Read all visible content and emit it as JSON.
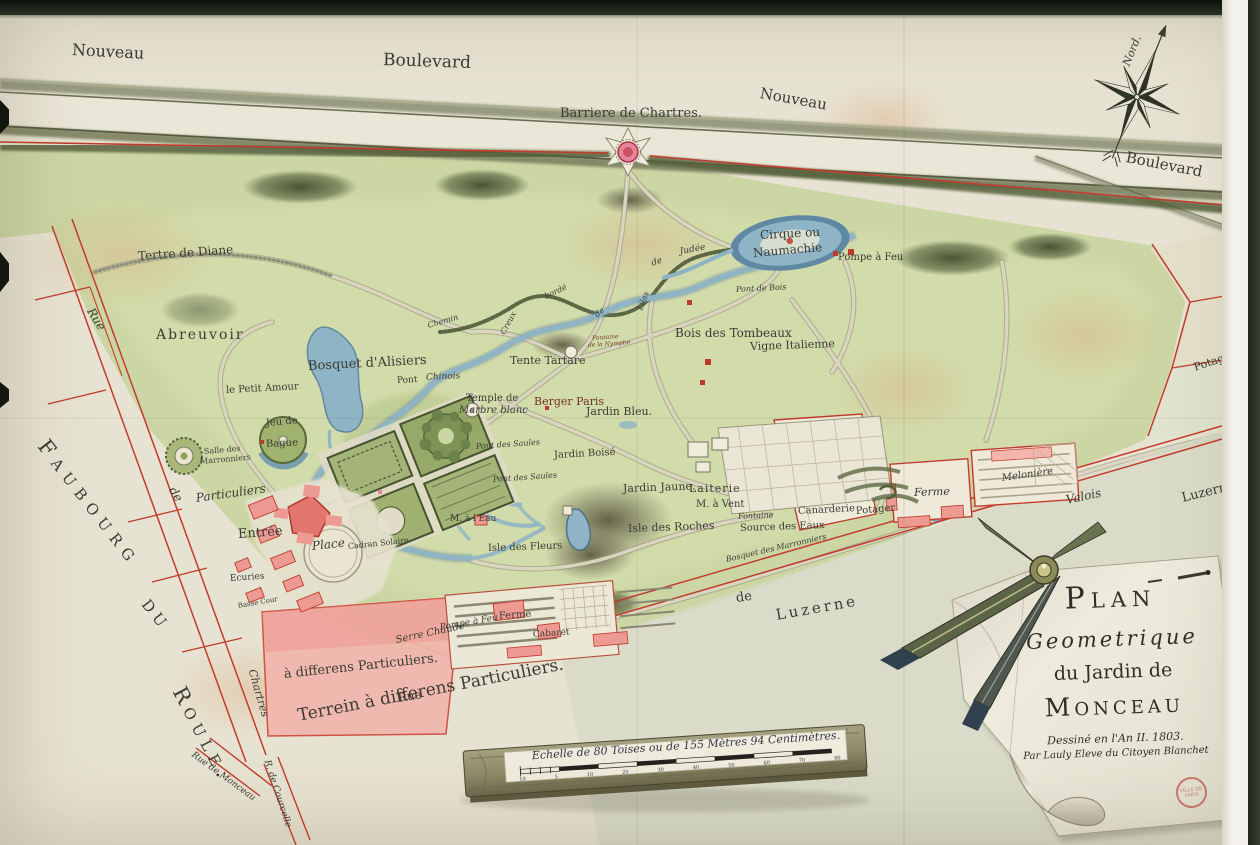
{
  "map": {
    "cartouche": {
      "line1": "Plan",
      "line2": "Geometrique",
      "line3": "du Jardin de",
      "line4": "Monceau",
      "line5": "Dessiné en l'An II. 1803.",
      "line6": "Par Lauly Eleve du Citoyen Blanchet",
      "stamp": "Ville de Paris"
    },
    "compass": {
      "north_label": "Nord."
    },
    "scale_bar": {
      "label": "Echelle de 80 Toises ou de 155 Mètres 94 Centimètres.",
      "ticks": [
        "10",
        "5",
        "10",
        "20",
        "30",
        "40",
        "50",
        "60",
        "70",
        "80"
      ]
    },
    "colors": {
      "paper": "#e7e3d2",
      "park_green": "#ccd6a4",
      "hedge": "#55603a",
      "water": "#8fb4c6",
      "boundary_red": "#c23b2c",
      "building_pink": "#ec9b94",
      "ink": "#3a3c34"
    },
    "labels": [
      {
        "id": "nouveau-left",
        "t": "Nouveau",
        "x": 72,
        "y": 42,
        "s": 16,
        "r": 3
      },
      {
        "id": "boulevard-top",
        "t": "Boulevard",
        "x": 383,
        "y": 52,
        "s": 17,
        "r": 2
      },
      {
        "id": "nouveau-right",
        "t": "Nouveau",
        "x": 760,
        "y": 86,
        "s": 15,
        "r": 10
      },
      {
        "id": "boulevard-right",
        "t": "Boulevard",
        "x": 1126,
        "y": 150,
        "s": 15,
        "r": 11
      },
      {
        "id": "barriere-de-chartres",
        "t": "Barriere de Chartres.",
        "x": 560,
        "y": 107,
        "s": 13,
        "r": 0
      },
      {
        "id": "tertre-de-diane",
        "t": "Tertre de Diane",
        "x": 138,
        "y": 250,
        "s": 12,
        "r": -4
      },
      {
        "id": "abreuvoir",
        "t": "Abreuvoir",
        "x": 156,
        "y": 328,
        "s": 14,
        "r": 0,
        "sp": 2
      },
      {
        "id": "le-petit-amour",
        "t": "le Petit Amour",
        "x": 226,
        "y": 386,
        "s": 10,
        "r": -3
      },
      {
        "id": "bosquet-d-alisiers",
        "t": "Bosquet d'Alisiers",
        "x": 308,
        "y": 360,
        "s": 13,
        "r": -3
      },
      {
        "id": "rue-left",
        "t": "Rue",
        "x": 90,
        "y": 303,
        "s": 12,
        "r": 58,
        "i": 1
      },
      {
        "id": "de-left",
        "t": "de",
        "x": 172,
        "y": 482,
        "s": 12,
        "r": 58,
        "i": 1
      },
      {
        "id": "chartres-left",
        "t": "Chartres",
        "x": 252,
        "y": 664,
        "s": 11,
        "r": 74,
        "i": 1
      },
      {
        "id": "rue-de-monceau",
        "t": "Rue de Monceau",
        "x": 192,
        "y": 750,
        "s": 9,
        "r": 36,
        "i": 1
      },
      {
        "id": "rue-de-courcelle",
        "t": "R. de Courcelle",
        "x": 266,
        "y": 756,
        "s": 9,
        "r": 72,
        "i": 1
      },
      {
        "id": "faubourg",
        "t": "Faubourg",
        "x": 42,
        "y": 432,
        "s": 21,
        "r": 52,
        "sp": 7,
        "sc": 1
      },
      {
        "id": "du",
        "t": "du",
        "x": 146,
        "y": 590,
        "s": 21,
        "r": 52,
        "sp": 5,
        "sc": 1
      },
      {
        "id": "roule",
        "t": "Roule.",
        "x": 178,
        "y": 678,
        "s": 21,
        "r": 62,
        "sp": 6,
        "sc": 1
      },
      {
        "id": "terrein-particuliers",
        "t": "Terrein    à    differens    Particuliers.",
        "x": 298,
        "y": 708,
        "s": 17,
        "r": -11
      },
      {
        "id": "differens-particuliers-pink",
        "t": "à   differens   Particuliers.",
        "x": 284,
        "y": 668,
        "s": 13,
        "r": -6
      },
      {
        "id": "rue-bottom",
        "t": "Rue",
        "x": 398,
        "y": 692,
        "s": 12,
        "r": -9
      },
      {
        "id": "particuliers-entree",
        "t": "Particuliers",
        "x": 196,
        "y": 492,
        "s": 12,
        "r": -8,
        "i": 1
      },
      {
        "id": "entree",
        "t": "Entrée",
        "x": 238,
        "y": 528,
        "s": 13,
        "r": -4
      },
      {
        "id": "place",
        "t": "Place",
        "x": 312,
        "y": 540,
        "s": 12,
        "r": -6,
        "i": 1
      },
      {
        "id": "cadran-solaire",
        "t": "Cadran Solaire",
        "x": 348,
        "y": 543,
        "s": 8,
        "r": -6
      },
      {
        "id": "ecuries",
        "t": "Ecuries",
        "x": 230,
        "y": 575,
        "s": 9,
        "r": -4
      },
      {
        "id": "basse-cour",
        "t": "Basse Cour",
        "x": 238,
        "y": 603,
        "s": 7,
        "r": -10
      },
      {
        "id": "jeu-de",
        "t": "Jeu de",
        "x": 266,
        "y": 419,
        "s": 10,
        "r": -5
      },
      {
        "id": "bague",
        "t": "Bague",
        "x": 266,
        "y": 440,
        "s": 10,
        "r": -3
      },
      {
        "id": "salle-des",
        "t": "Salle des",
        "x": 204,
        "y": 448,
        "s": 8,
        "r": -5
      },
      {
        "id": "marronniers",
        "t": "Marronniers",
        "x": 200,
        "y": 458,
        "s": 8,
        "r": -5
      },
      {
        "id": "serre-chaude",
        "t": "Serre Chaude",
        "x": 396,
        "y": 636,
        "s": 10,
        "r": -12,
        "i": 1
      },
      {
        "id": "pompe-a-feu-bas",
        "t": "Pompe à Feu",
        "x": 440,
        "y": 624,
        "s": 9,
        "r": -10,
        "i": 1
      },
      {
        "id": "ferme-bas",
        "t": "Ferme",
        "x": 499,
        "y": 612,
        "s": 10,
        "r": -4
      },
      {
        "id": "cabaret",
        "t": "Cabaret",
        "x": 533,
        "y": 631,
        "s": 9,
        "r": -4
      },
      {
        "id": "temple-de",
        "t": "Temple de",
        "x": 466,
        "y": 394,
        "s": 10,
        "r": 0
      },
      {
        "id": "marbre-blanc",
        "t": "Marbre blanc",
        "x": 459,
        "y": 406,
        "s": 10,
        "r": 0,
        "i": 1
      },
      {
        "id": "tente-tartare",
        "t": "Tente Tartare",
        "x": 510,
        "y": 355,
        "s": 11,
        "r": 0
      },
      {
        "id": "berger-paris",
        "t": "Berger Paris",
        "x": 534,
        "y": 396,
        "s": 11,
        "r": 0,
        "c": "#71352a"
      },
      {
        "id": "jardin-bleu",
        "t": "Jardin Bleu.",
        "x": 586,
        "y": 406,
        "s": 11,
        "r": 0
      },
      {
        "id": "jardin-boise",
        "t": "Jardin Boisé",
        "x": 554,
        "y": 451,
        "s": 10,
        "r": -3
      },
      {
        "id": "pont-des-saules-1",
        "t": "Pont des Saules",
        "x": 476,
        "y": 443,
        "s": 8,
        "r": -4,
        "i": 1
      },
      {
        "id": "pont-des-saules-2",
        "t": "Pont des Saules",
        "x": 493,
        "y": 476,
        "s": 8,
        "r": -4,
        "i": 1
      },
      {
        "id": "pont",
        "t": "Pont",
        "x": 397,
        "y": 377,
        "s": 9,
        "r": -3
      },
      {
        "id": "pont-chinois",
        "t": "Chinois",
        "x": 426,
        "y": 374,
        "s": 9,
        "r": -3,
        "i": 1
      },
      {
        "id": "chemin",
        "t": "Chemin",
        "x": 428,
        "y": 322,
        "s": 8,
        "r": -16,
        "i": 1
      },
      {
        "id": "creux",
        "t": "Creux",
        "x": 503,
        "y": 330,
        "s": 8,
        "r": -62,
        "i": 1
      },
      {
        "id": "borde",
        "t": "bordé",
        "x": 545,
        "y": 293,
        "s": 8,
        "r": -25,
        "i": 1
      },
      {
        "id": "de-lilas",
        "t": "de",
        "x": 596,
        "y": 312,
        "s": 8,
        "r": -40,
        "i": 1
      },
      {
        "id": "lilas",
        "t": "Lilas",
        "x": 640,
        "y": 306,
        "s": 8,
        "r": -68,
        "i": 1
      },
      {
        "id": "de-judee",
        "t": "de",
        "x": 652,
        "y": 260,
        "s": 9,
        "r": -20,
        "i": 1
      },
      {
        "id": "judee",
        "t": "Judée",
        "x": 680,
        "y": 248,
        "s": 9,
        "r": -10,
        "i": 1
      },
      {
        "id": "fontaine-nymphe-1",
        "t": "Fontaine",
        "x": 592,
        "y": 336,
        "s": 6,
        "r": -4,
        "i": 1,
        "c": "#71352a"
      },
      {
        "id": "fontaine-nymphe-2",
        "t": "de la Nymphe",
        "x": 588,
        "y": 343,
        "s": 6,
        "r": -4,
        "i": 1,
        "c": "#71352a"
      },
      {
        "id": "cirque-ou",
        "t": "Cirque ou",
        "x": 760,
        "y": 229,
        "s": 12,
        "r": -3
      },
      {
        "id": "naumachie",
        "t": "Naumachie",
        "x": 753,
        "y": 247,
        "s": 12,
        "r": -5
      },
      {
        "id": "pompe-a-feu-droite",
        "t": "Pompe à Feu",
        "x": 838,
        "y": 253,
        "s": 10,
        "r": 0
      },
      {
        "id": "pont-de-bois",
        "t": "Pont de Bois",
        "x": 736,
        "y": 286,
        "s": 8,
        "r": -3,
        "i": 1
      },
      {
        "id": "bois-des-tombeaux",
        "t": "Bois des Tombeaux",
        "x": 675,
        "y": 327,
        "s": 12,
        "r": 0
      },
      {
        "id": "vigne-italienne",
        "t": "Vigne Italienne",
        "x": 750,
        "y": 341,
        "s": 11,
        "r": -2
      },
      {
        "id": "jardin-jaune",
        "t": "Jardin Jaune.",
        "x": 623,
        "y": 483,
        "s": 11,
        "r": -2
      },
      {
        "id": "laiterie",
        "t": "Laiterie",
        "x": 689,
        "y": 483,
        "s": 11,
        "r": 0,
        "sp": 1
      },
      {
        "id": "m-a-vent",
        "t": "M. à Vent",
        "x": 696,
        "y": 500,
        "s": 10,
        "r": 0
      },
      {
        "id": "fontaine-source",
        "t": "Fontaine",
        "x": 738,
        "y": 513,
        "s": 8,
        "r": -3,
        "i": 1
      },
      {
        "id": "source-des-eaux",
        "t": "Source des Eaux",
        "x": 740,
        "y": 524,
        "s": 10,
        "r": -2
      },
      {
        "id": "isle-des-roches",
        "t": "Isle des Roches",
        "x": 628,
        "y": 523,
        "s": 11,
        "r": -2
      },
      {
        "id": "canarderie",
        "t": "Canarderie",
        "x": 798,
        "y": 507,
        "s": 10,
        "r": -3
      },
      {
        "id": "potager-mid",
        "t": "Potager",
        "x": 856,
        "y": 507,
        "s": 10,
        "r": -5
      },
      {
        "id": "bosquet-des-marronniers",
        "t": "Bosquet des Marronniers",
        "x": 726,
        "y": 556,
        "s": 8,
        "r": -13,
        "i": 1
      },
      {
        "id": "m-a-l-eau",
        "t": "M. à l'Eau",
        "x": 450,
        "y": 515,
        "s": 9,
        "r": 0
      },
      {
        "id": "isle-des-fleurs",
        "t": "Isle des Fleurs",
        "x": 488,
        "y": 544,
        "s": 10,
        "r": -2
      },
      {
        "id": "ferme-droite",
        "t": "Ferme",
        "x": 914,
        "y": 487,
        "s": 11,
        "r": -2,
        "i": 1
      },
      {
        "id": "meloniere",
        "t": "Melonière",
        "x": 1002,
        "y": 474,
        "s": 10,
        "r": -8,
        "i": 1
      },
      {
        "id": "valois",
        "t": "Valois",
        "x": 1066,
        "y": 494,
        "s": 12,
        "r": -12,
        "i": 1
      },
      {
        "id": "luzerne-droite",
        "t": "Luzerne",
        "x": 1182,
        "y": 492,
        "s": 13,
        "r": -14
      },
      {
        "id": "potagers-droite",
        "t": "Potagers",
        "x": 1194,
        "y": 362,
        "s": 11,
        "r": -18
      },
      {
        "id": "de-luzerne",
        "t": "de",
        "x": 736,
        "y": 592,
        "s": 13,
        "r": -8
      },
      {
        "id": "luzerne-grand",
        "t": "Luzerne",
        "x": 776,
        "y": 608,
        "s": 15,
        "r": -10,
        "sp": 3
      },
      {
        "id": "nord",
        "t": "Nord.",
        "x": 1126,
        "y": 60,
        "s": 11,
        "r": -68,
        "i": 1
      }
    ]
  }
}
